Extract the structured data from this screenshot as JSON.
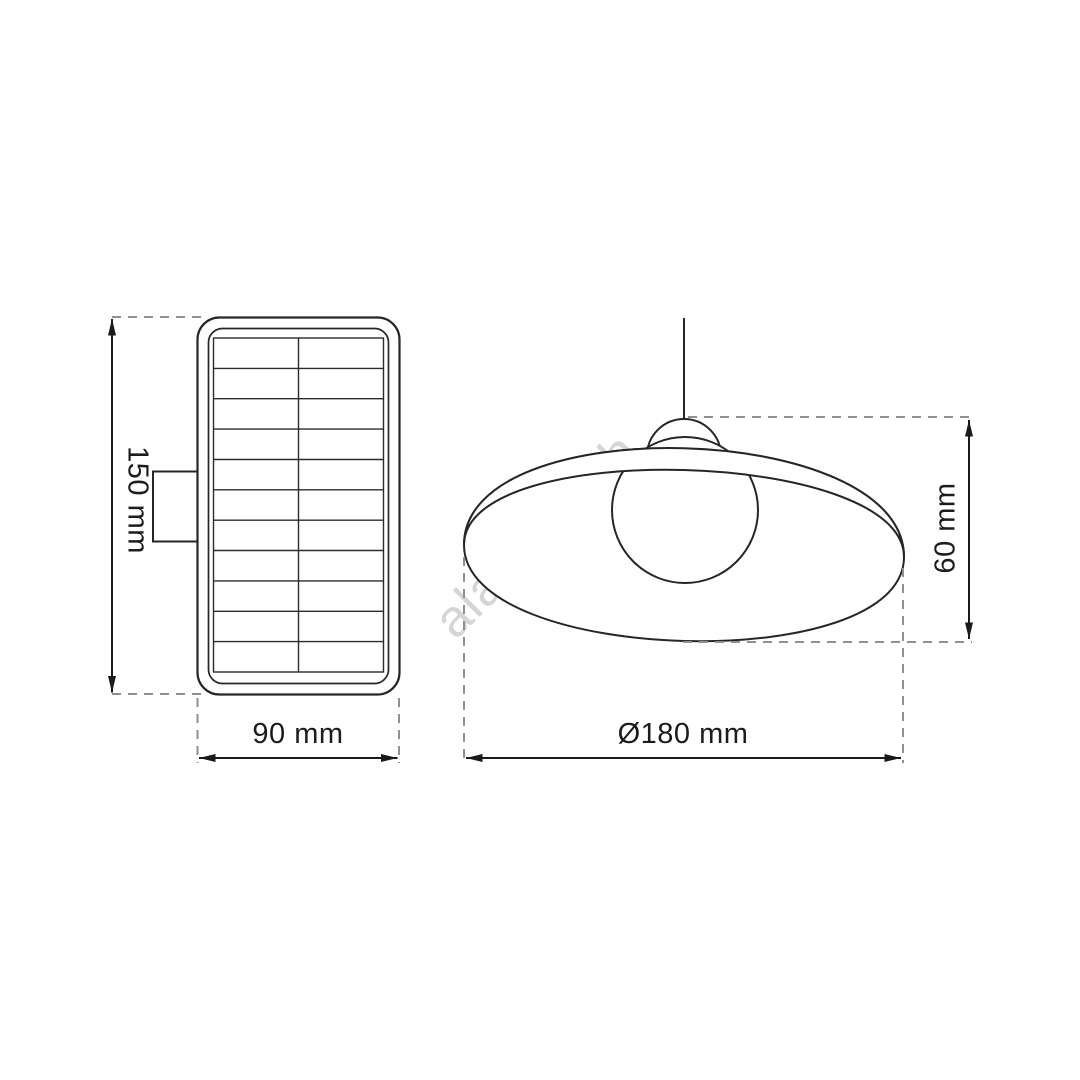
{
  "diagram": {
    "watermark": {
      "text": "alasans.ch",
      "color": "#d5d5d5"
    },
    "views": {
      "solar_panel": {
        "description": "solar-panel-front-view",
        "grid": {
          "rows": 11,
          "columns": 2
        },
        "dimensions": {
          "height_label": "150 mm",
          "width_label": "90 mm"
        }
      },
      "pendant_lamp": {
        "description": "pendant-lamp-shade-side-view",
        "dimensions": {
          "diameter_label": "Ø180 mm",
          "height_label": "60 mm"
        }
      }
    },
    "colors": {
      "background": "#ffffff",
      "outline": "#262626",
      "dimension_line": "#1a1a1a",
      "extension_line": "#8f8f8f",
      "label_text": "#1c1c1c",
      "watermark": "#d5d5d5"
    }
  }
}
